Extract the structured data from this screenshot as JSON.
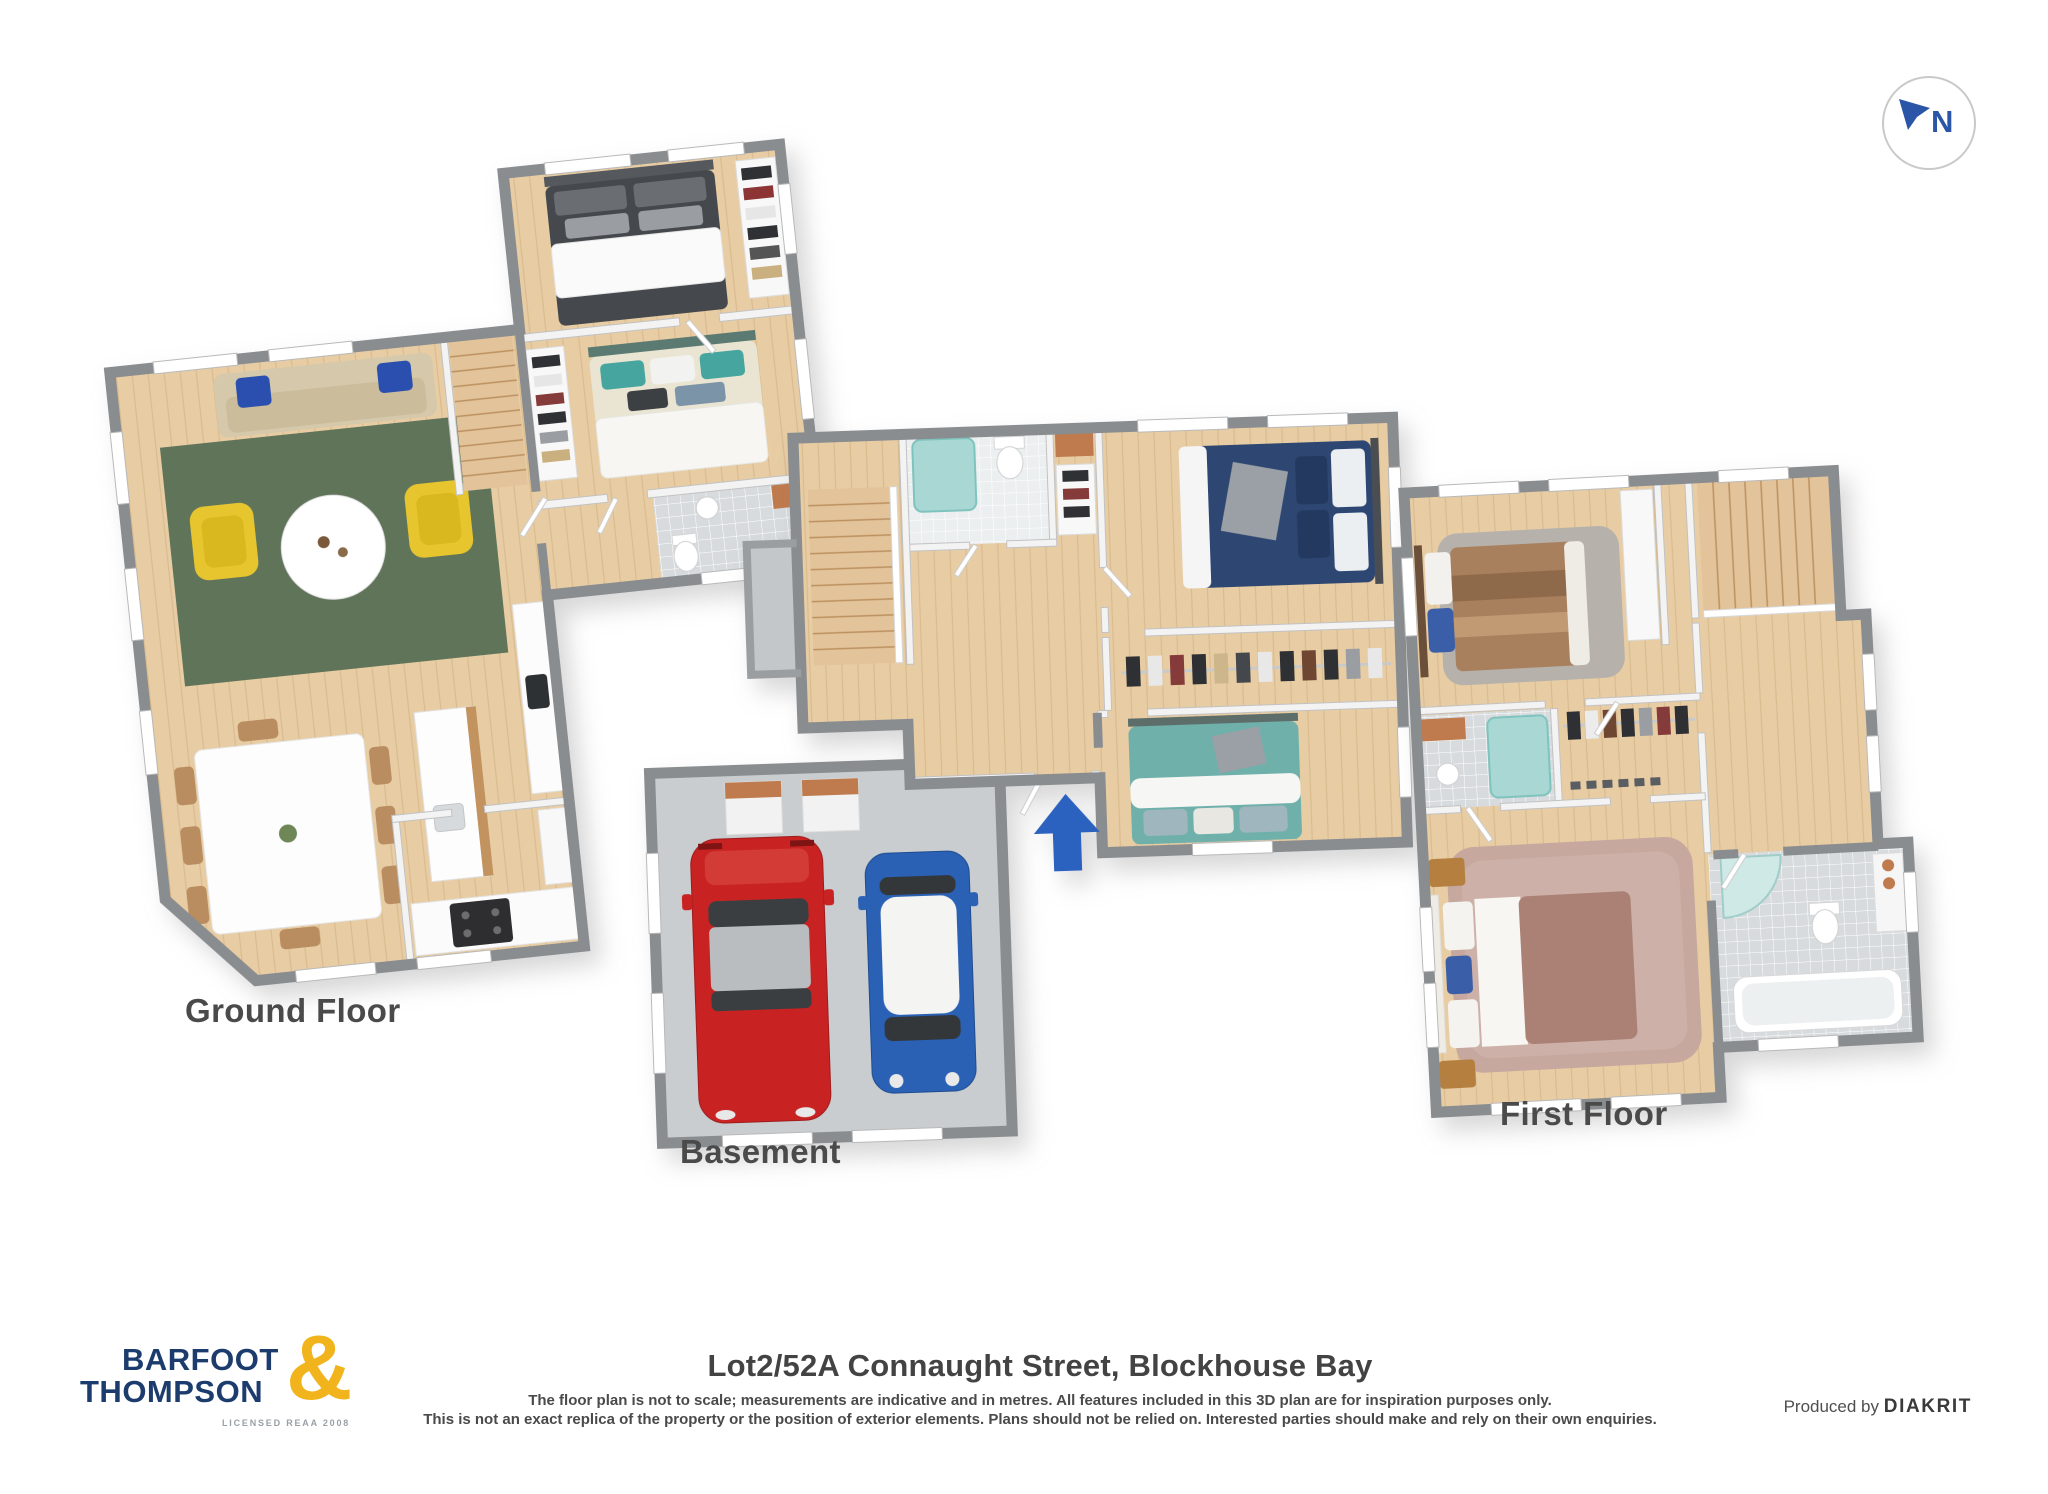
{
  "page": {
    "background": "#ffffff"
  },
  "compass": {
    "label": "N"
  },
  "plans": {
    "ground": {
      "label": "Ground Floor"
    },
    "basement": {
      "label": "Basement"
    },
    "first": {
      "label": "First Floor"
    }
  },
  "footer": {
    "address": "Lot2/52A Connaught Street, Blockhouse Bay",
    "disclaimer1": "The floor plan is not to scale; measurements are indicative and in metres. All features included in this 3D plan are for inspiration purposes only.",
    "disclaimer2": "This is not an exact replica of the property or the position of exterior elements. Plans should not be relied on. Interested parties should make and rely on their own enquiries.",
    "produced_by": "Produced by",
    "producer": "DIAKRIT"
  },
  "logo": {
    "line1": "BARFOOT",
    "line2": "THOMPSON",
    "ampersand": "&",
    "license": "LICENSED REAA 2008"
  },
  "colors": {
    "brand_navy": "#1b3c6d",
    "brand_gold": "#f1b41c",
    "compass_blue": "#2b56a7",
    "entry_arrow_blue": "#2b62c0",
    "car_red": "#c82322",
    "car_blue": "#2a61b4",
    "wall_gray": "#8a8d90",
    "wood_floor": "#e8cda4",
    "rug_green": "#60745a",
    "chair_yellow": "#e6c52f",
    "label_gray": "#4a4a4a"
  },
  "icons": {
    "compass": "compass-icon",
    "entry_arrow": "entry-arrow-icon"
  }
}
